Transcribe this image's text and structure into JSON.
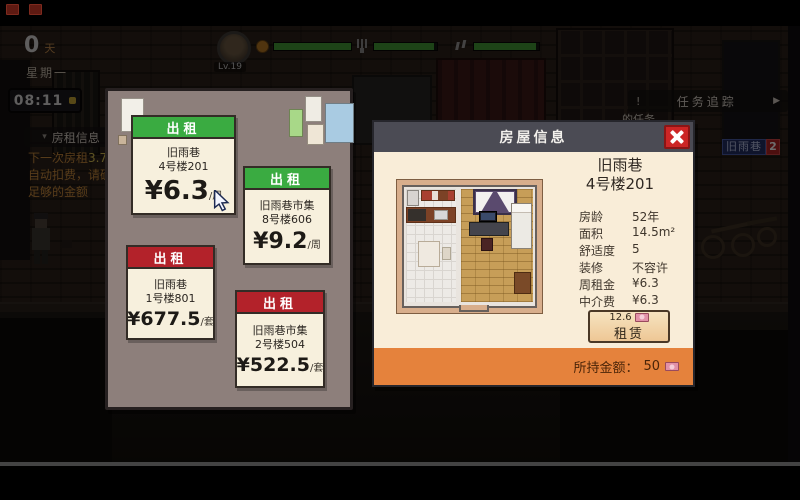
{
  "colors": {
    "listing_green": "#3aab41",
    "listing_red": "#b3222a",
    "panel_cream": "#f9edd8",
    "footer_orange": "#e5823c",
    "close_red": "#cc2525",
    "statbar_green": "#3f9c33"
  },
  "icons": {
    "close": "✕",
    "arrow_right": "▶",
    "collapse": "▾",
    "alert": "!",
    "money": "banknote"
  },
  "hud": {
    "day_value": "0",
    "day_unit": "天",
    "weekday": "星期一",
    "time": "08:11",
    "level": "Lv.19",
    "bars": [
      100,
      95,
      95
    ],
    "task_tracker_label": "任务追踪",
    "task_fragment": "的任务",
    "location_badge": {
      "label": "旧雨巷",
      "count": "2"
    }
  },
  "rent_info": {
    "header": "房租信息",
    "notice_prefix": "下一次房租",
    "notice_amount": "3.75",
    "notice_line2": "自动扣费，请确保",
    "notice_line3": "足够的金额"
  },
  "listings_panel": {
    "cards": [
      {
        "tag": "出租",
        "color": "green",
        "line1": "旧雨巷",
        "line2": "4号楼201",
        "price": "¥6.3",
        "unit": "/周"
      },
      {
        "tag": "出租",
        "color": "green",
        "line1": "旧雨巷市集",
        "line2": "8号楼606",
        "price": "¥9.2",
        "unit": "/周"
      },
      {
        "tag": "出租",
        "color": "red",
        "line1": "旧雨巷",
        "line2": "1号楼801",
        "price": "¥677.5",
        "unit": "/套"
      },
      {
        "tag": "出租",
        "color": "red",
        "line1": "旧雨巷市集",
        "line2": "2号楼504",
        "price": "¥522.5",
        "unit": "/套"
      }
    ]
  },
  "info_panel": {
    "title": "房屋信息",
    "house_line1": "旧雨巷",
    "house_line2": "4号楼201",
    "details": [
      {
        "label": "房龄",
        "value": "52年"
      },
      {
        "label": "面积",
        "value": "14.5m²"
      },
      {
        "label": "舒适度",
        "value": "5"
      },
      {
        "label": "装修",
        "value": "不容许"
      },
      {
        "label": "周租金",
        "value": "¥6.3"
      },
      {
        "label": "中介费",
        "value": "¥6.3"
      }
    ],
    "rent_button": {
      "cost": "12.6",
      "label": "租赁"
    },
    "footer": {
      "label": "所持金额：",
      "value": "50"
    }
  }
}
